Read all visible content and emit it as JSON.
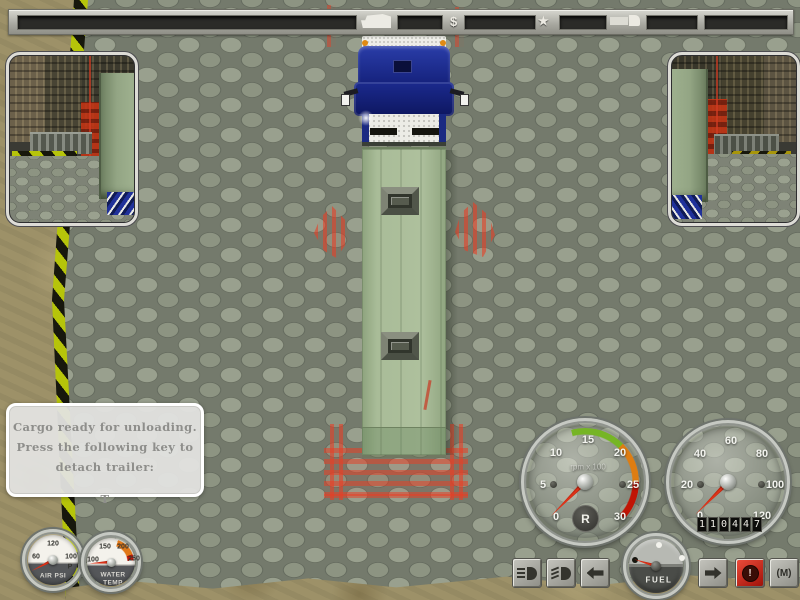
{
  "top_bar": {
    "currency_symbol": "$",
    "star_symbol": "★",
    "icons": [
      "truck-cab-icon",
      "dollar-symbol",
      "star-symbol",
      "truck-trailer-icon"
    ]
  },
  "message_box": {
    "line1": "Cargo ready for unloading.",
    "line2": "Press the following key to",
    "line3": "detach trailer:",
    "key_hint": "T"
  },
  "gauges": {
    "air_pressure": {
      "label": "AIR PSI",
      "tick_left": "60",
      "tick_top": "120",
      "tick_right": "100",
      "tick_unit": "P"
    },
    "water_temp": {
      "label_line1": "WATER",
      "label_line2": "TEMP",
      "tick_left": "100",
      "tick_top_left": "150",
      "tick_top_right": "200",
      "tick_right": "250",
      "warn_arc_color": "#e07818",
      "danger_arc_color": "#c01808"
    },
    "tachometer": {
      "unit_label": "rpm x 100",
      "ticks": [
        "0",
        "5",
        "10",
        "15",
        "20",
        "25",
        "30"
      ],
      "gear_indicator": "R",
      "arc_green": "#76b525",
      "arc_orange": "#de7d12",
      "arc_red": "#c01505"
    },
    "speedometer": {
      "ticks": [
        "0",
        "20",
        "40",
        "60",
        "80",
        "100",
        "120"
      ],
      "odometer": [
        "1",
        "1",
        "0",
        "4",
        "4",
        "7"
      ]
    },
    "fuel": {
      "label": "FUEL"
    }
  },
  "controls": {
    "buttons": [
      {
        "name": "headlights"
      },
      {
        "name": "fog-lights"
      },
      {
        "name": "turn-left"
      },
      {
        "name": "turn-right"
      },
      {
        "name": "hazard",
        "symbol": "!"
      },
      {
        "name": "map",
        "label": "(M)"
      }
    ]
  },
  "colors": {
    "truck_cab_blue": "#1c2b8e",
    "trailer_green": "#a7ba97",
    "marker_red": "#e13c23",
    "needle_red": "#cc1e10"
  }
}
